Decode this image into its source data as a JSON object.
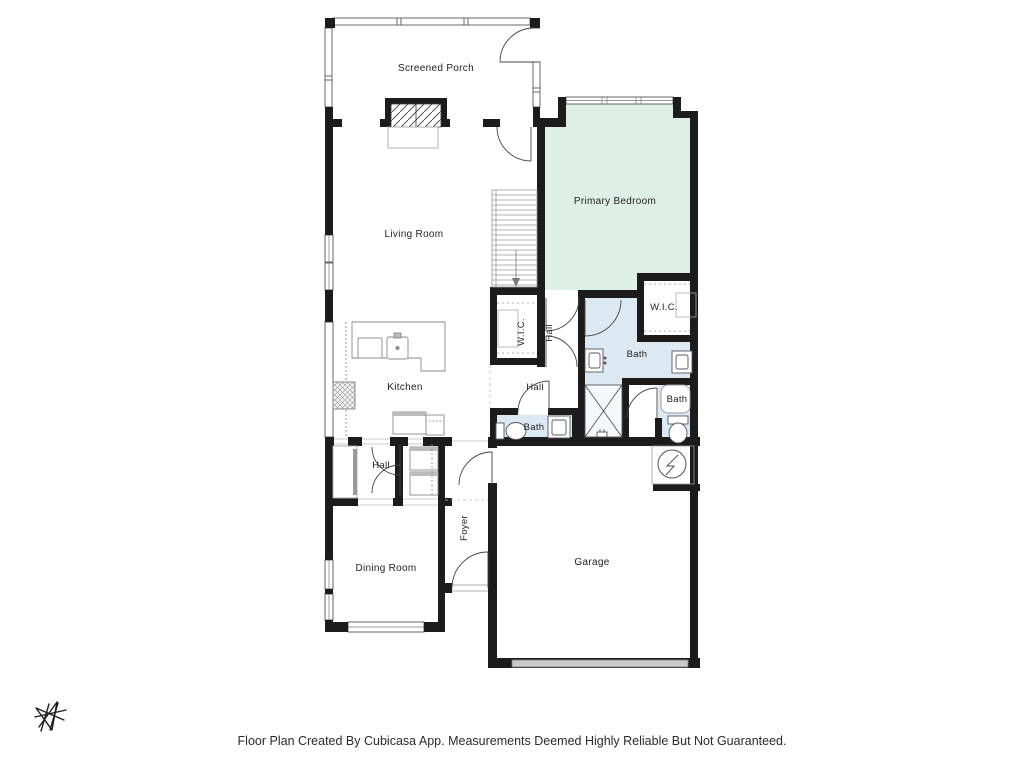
{
  "rooms": {
    "screened_porch": "Screened Porch",
    "living_room": "Living Room",
    "primary_bedroom": "Primary Bedroom",
    "kitchen": "Kitchen",
    "dining_room": "Dining Room",
    "garage": "Garage",
    "foyer": "Foyer",
    "wic_primary": "W.I.C.",
    "wic_secondary": "W.I.C.",
    "hall_bedroom": "Hall",
    "hall_center": "Hall",
    "hall_rear": "Hall",
    "bath_primary": "Bath",
    "bath_secondary": "Bath",
    "bath_half": "Bath"
  },
  "footer": {
    "disclaimer": "Floor Plan Created By Cubicasa App. Measurements Deemed Highly Reliable But Not Guaranteed."
  },
  "colors": {
    "wall": "#1c1c1c",
    "bedroom_fill": "#ddefe7",
    "bath_fill": "#dce9f3",
    "label_text": "#1f1f1f"
  },
  "icons": {
    "water_heater": "circle-lightning-bolt",
    "brand_logo": "hand-drawn-star-monogram"
  }
}
